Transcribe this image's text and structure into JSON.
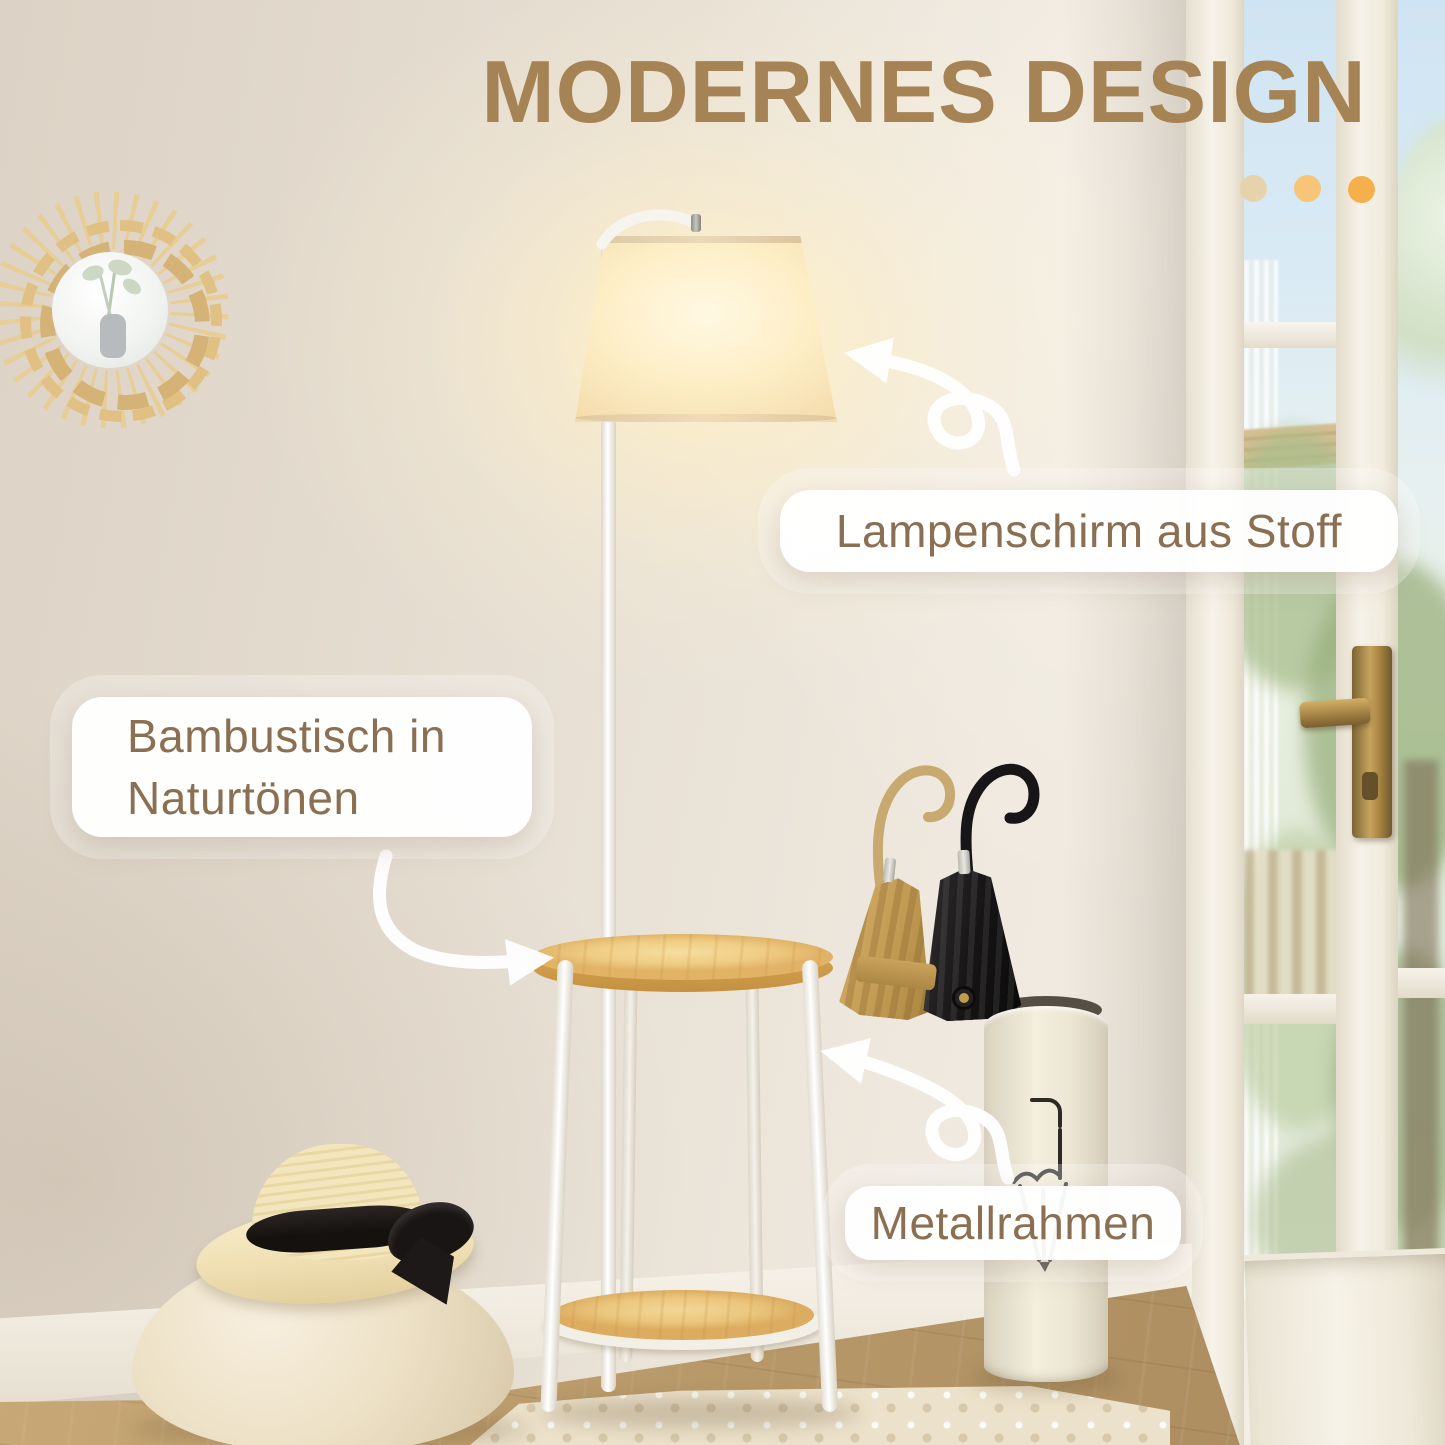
{
  "title": "MODERNES DESIGN",
  "callouts": {
    "lampshade": {
      "label": "Lampenschirm aus Stoff"
    },
    "table": {
      "line1": "Bambustisch in",
      "line2": "Naturtönen"
    },
    "frame": {
      "label": "Metallrahmen"
    }
  },
  "accent_dots": [
    "#e6d3ab",
    "#f7c577",
    "#f6b04b"
  ],
  "colors": {
    "title_text": "#a58355",
    "callout_text": "#8a6f52",
    "callout_bg": "#ffffff",
    "wall": "#e9e1d5",
    "bamboo_top": "#eec87e",
    "lamp_glow": "#ffefc8",
    "floor_wood": "#b99a6a",
    "sky": "#cfe4f2",
    "foliage": "#aec394",
    "brass_handle": "#b08f4e",
    "arrow": "#ffffff"
  },
  "scene": {
    "items": [
      "sun-rattan-mirror",
      "floor-lamp-with-fabric-shade",
      "bamboo-side-table",
      "umbrella-stand",
      "tan-umbrella",
      "black-umbrella",
      "pouf-with-straw-hat",
      "french-door",
      "area-rug"
    ]
  }
}
